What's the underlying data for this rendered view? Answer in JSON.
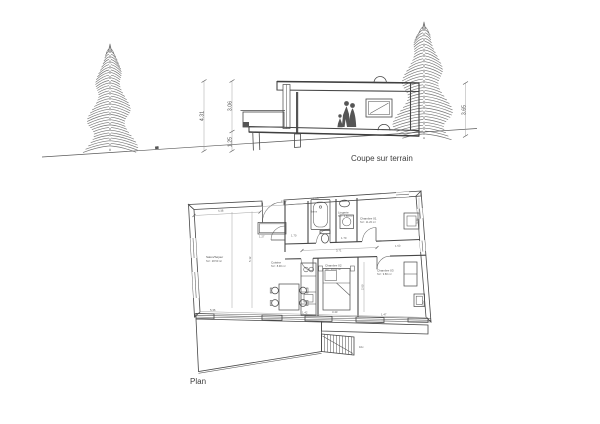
{
  "drawing": {
    "paper_color": "#ffffff",
    "ink_color": "#474747",
    "hatch_color": "#8f8f8f",
    "text_color": "#3d3d3d"
  },
  "section": {
    "caption": "Coupe sur terrain",
    "dims": {
      "total_height": "4.31",
      "upper": "3.06",
      "plinth": "1.25",
      "right_height": "3.65"
    }
  },
  "plan": {
    "caption": "Plan",
    "stairs_note": "10x",
    "rooms": [
      {
        "name": "Salon/Séjour",
        "area": "SU : 28.50 m²"
      },
      {
        "name": "Cuisine",
        "area": "SU : 8.90 m²"
      },
      {
        "name": "Lingerie",
        "area": "SU : 4.60 m²"
      },
      {
        "name": "Bains",
        "area": "SU : 5.10 m²"
      },
      {
        "name": "Chambre 01",
        "area": "SU : 11.20 m²"
      },
      {
        "name": "Chambre 02",
        "area": "SU : 10.60 m²"
      },
      {
        "name": "Chambre 03",
        "area": "SU : 9.80 m²"
      }
    ],
    "dims": [
      "4.38",
      "5.12",
      "2.43",
      "1.05",
      "1.27",
      "1.70",
      "3.71",
      "1.50",
      "3.70",
      "2.60",
      "5.36",
      "1.42",
      "3.43",
      "1.47",
      "1.62",
      "1.70"
    ]
  }
}
